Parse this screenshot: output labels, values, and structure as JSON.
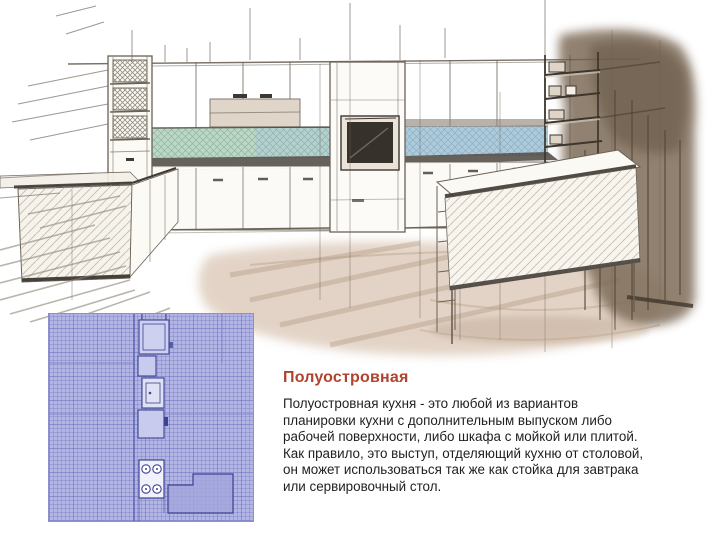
{
  "article": {
    "title": "Полуостровная",
    "title_color": "#b0432e",
    "body_lines": [
      "Полуостровная кухня - это любой из вариантов",
      "планировки кухни с дополнительным выпуском либо",
      "рабочей поверхности, либо шкафа с мойкой или плитой.",
      "Как правило, это выступ, отделяющий кухню от столовой,",
      "он может использоваться так же как стойка для завтрака",
      "или сервировочный стол."
    ]
  },
  "illustration": {
    "label": "kitchen-perspective-sketch",
    "palette": {
      "pencil": "#6a6156",
      "backsplash_green": "#bcd7c6",
      "backsplash_blue": "#aecbdb",
      "counter_edge": "#57504a",
      "wall_wash": "#7e6c59",
      "wall_wash_dark": "#5e4f3e",
      "floor_wash": "#c7a98f",
      "oven_screen": "#37312b",
      "shelf_band": "#dbcec0"
    }
  },
  "floor_plan": {
    "label": "kitchen-floor-plan-blueprint",
    "palette": {
      "background": "#b3b6e3",
      "grid": "#7478c4",
      "outline": "#3d4292",
      "fixture_fill": "#c9cbee",
      "oven_fill": "#dfe1f4",
      "stove_fill": "#f0f1fa",
      "peninsula_fill": "#a3a6dc"
    }
  }
}
